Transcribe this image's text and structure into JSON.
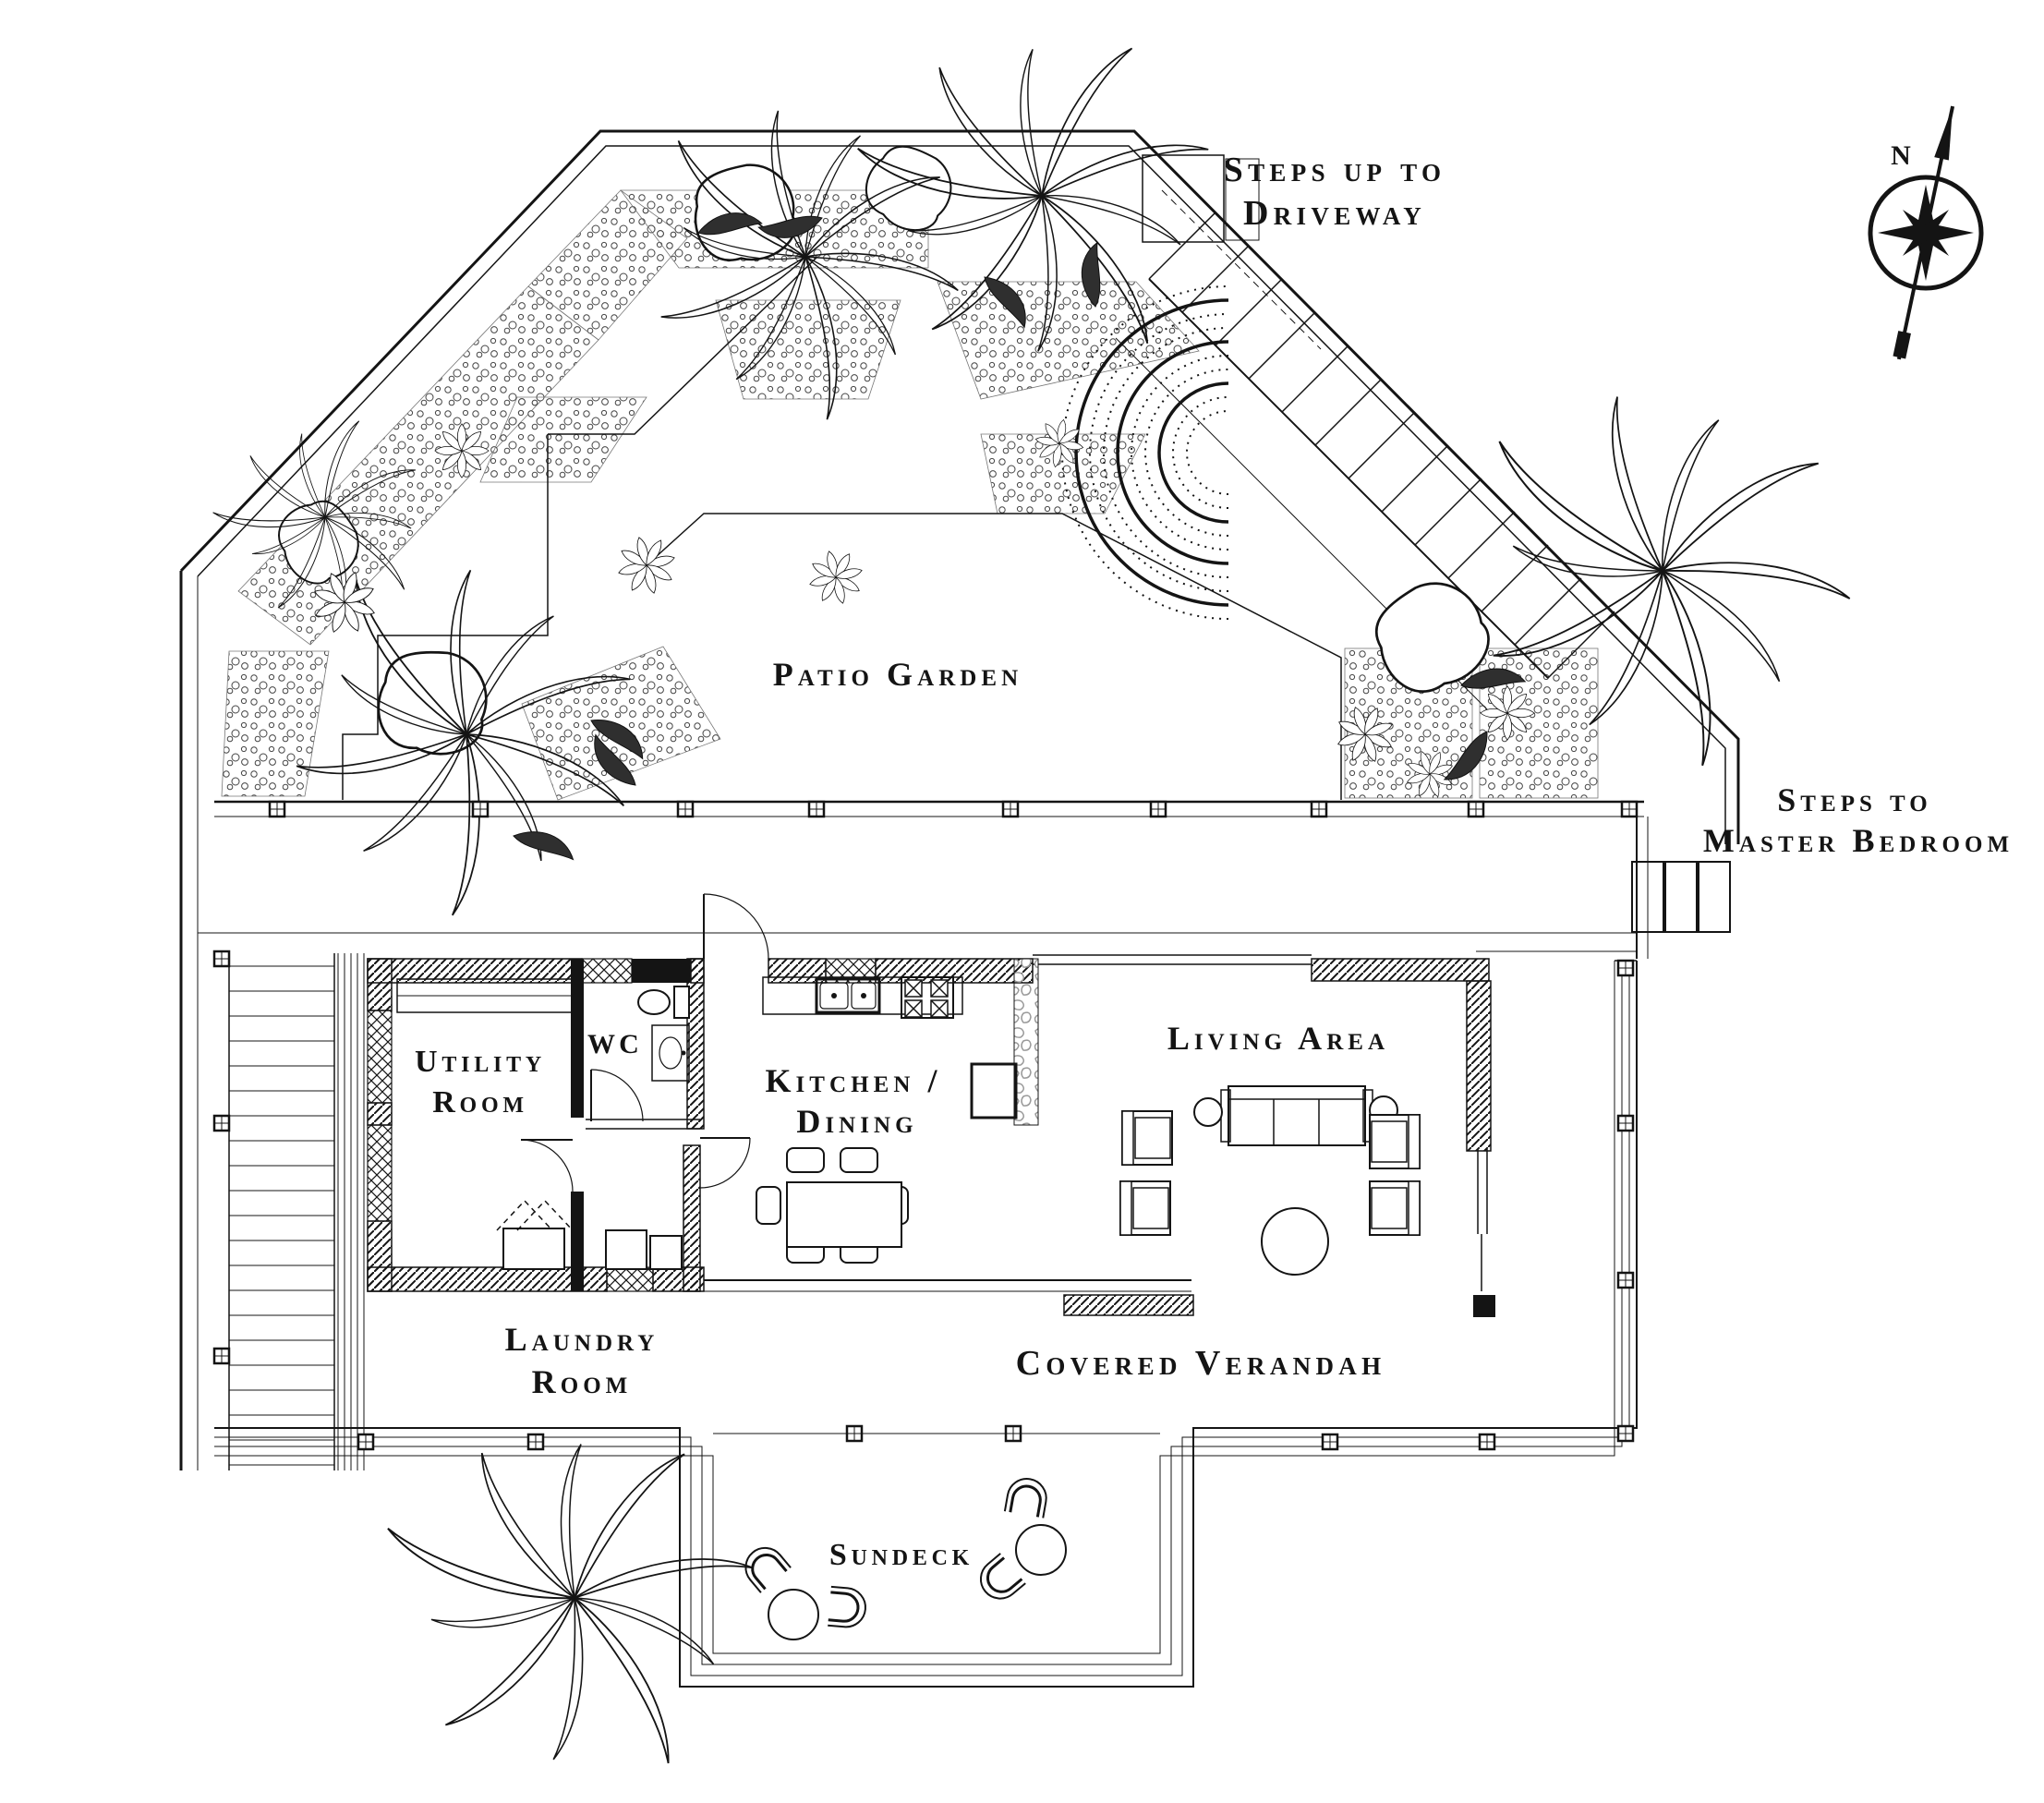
{
  "document": {
    "type": "architectural-floor-plan",
    "style": "black-ink line drawing on white"
  },
  "labels": {
    "steps_driveway": {
      "line1": "Steps up to",
      "line2": "Driveway"
    },
    "patio_garden": "Patio Garden",
    "steps_master": {
      "line1": "Steps to",
      "line2": "Master Bedroom"
    },
    "utility": {
      "line1": "Utility",
      "line2": "Room"
    },
    "wc": "WC",
    "kitchen": {
      "line1": "Kitchen /",
      "line2": "Dining"
    },
    "living": "Living Area",
    "laundry": {
      "line1": "Laundry",
      "line2": "Room"
    },
    "verandah": "Covered Verandah",
    "sundeck": "Sundeck",
    "compass_north": "N"
  },
  "colors": {
    "ink": "#141414",
    "paper": "#ffffff",
    "stone_wall": "#9a9a9a"
  }
}
